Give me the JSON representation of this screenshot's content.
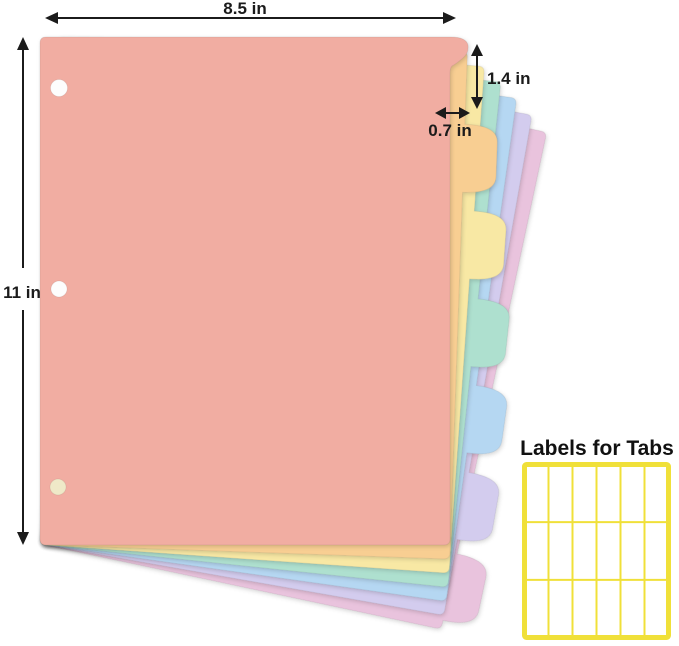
{
  "annotations": {
    "sheet_width_label": "8.5 in",
    "sheet_height_label": "11 in",
    "tab_height_label": "1.4 in",
    "tab_width_label": "0.7 in",
    "color": "#1b1b1b"
  },
  "divider_stack": {
    "sheet_count": 7,
    "hole_count": 3,
    "hole_color": "#FDFDFD",
    "bottom_hole_color": "#EFE9C8",
    "sheets": [
      {
        "name": "salmon",
        "color": "#F1ADA2"
      },
      {
        "name": "orange",
        "color": "#F8CE92"
      },
      {
        "name": "yellow",
        "color": "#F8E8A4"
      },
      {
        "name": "teal",
        "color": "#AEE0CF"
      },
      {
        "name": "blue",
        "color": "#B5D7F2"
      },
      {
        "name": "lavender",
        "color": "#D3CCEE"
      },
      {
        "name": "pink",
        "color": "#E9C3DD"
      }
    ]
  },
  "labels_panel": {
    "title": "Labels for Tabs",
    "grid": {
      "columns": 6,
      "rows": 3
    },
    "border_color": "#F0E039",
    "cell_color": "#FFFFFF"
  },
  "background": "#FFFFFF"
}
